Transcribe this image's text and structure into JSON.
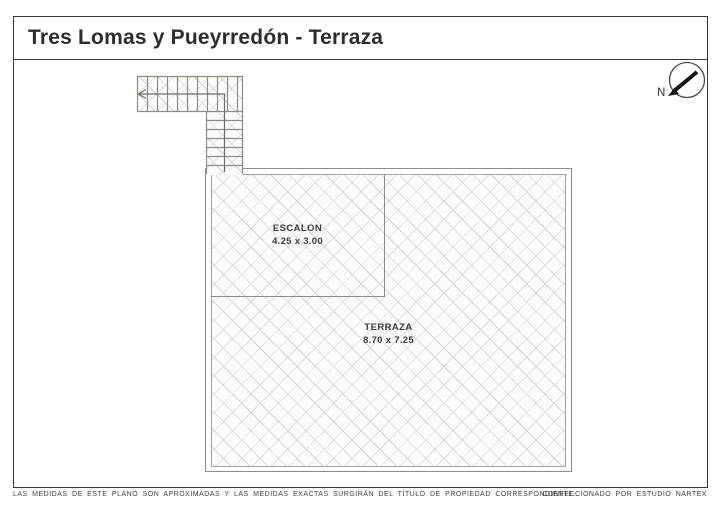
{
  "title": "Tres Lomas y Pueyrredón - Terraza",
  "plan": {
    "rooms": [
      {
        "name": "ESCALON",
        "dimensions": "4.25 x 3.00"
      },
      {
        "name": "TERRAZA",
        "dimensions": "8.70 x 7.25"
      }
    ],
    "north_label": "N"
  },
  "footer": {
    "disclaimer": "LAS MEDIDAS  DE ESTE PLANO SON APROXIMADAS Y LAS MEDIDAS EXACTAS SURGIRÁN DEL  TÍTULO DE PROPIEDAD CORRESPONDIENTE.",
    "credit": "CONFECCIONADO POR ESTUDIO NARTEX"
  },
  "colors": {
    "frame": "#383838",
    "plan_line": "#8e8a86",
    "hatch_line": "#d7d3cf",
    "label_text": "#3f3b38",
    "needle": "#141414"
  }
}
